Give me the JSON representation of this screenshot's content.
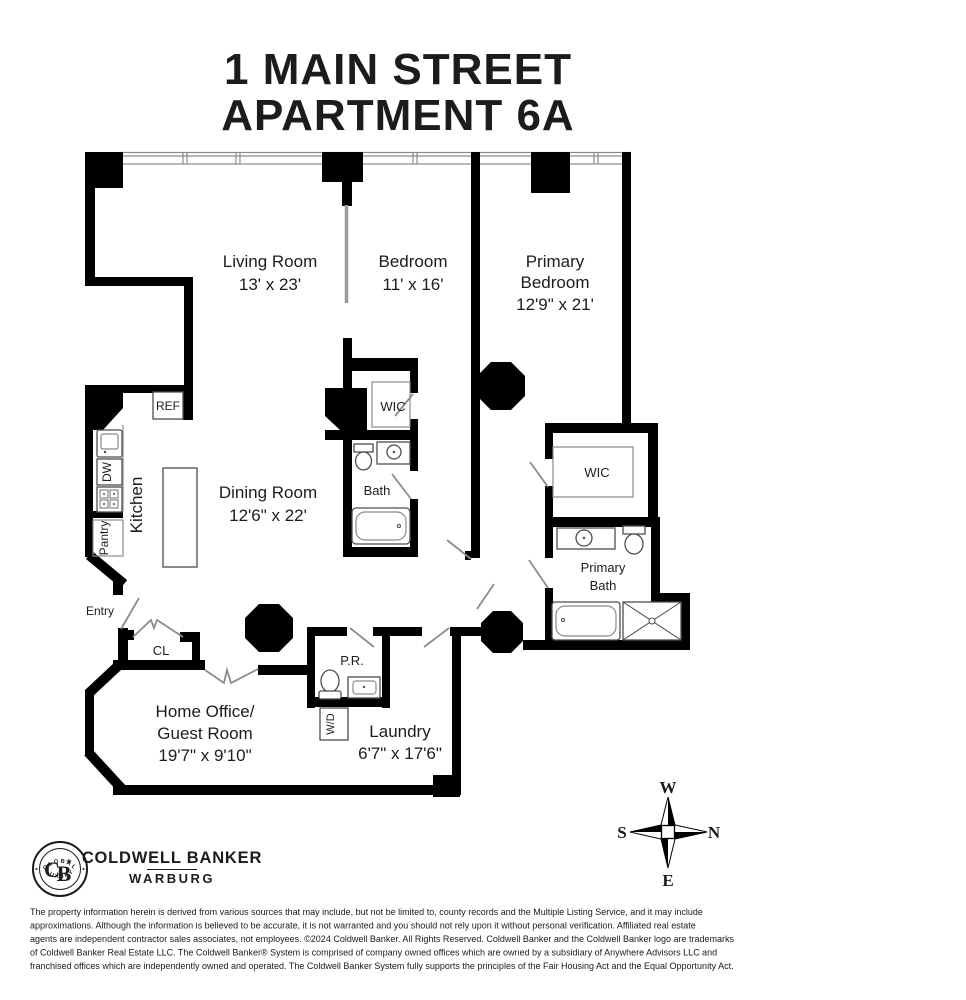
{
  "title": {
    "line1": "1 MAIN STREET",
    "line2": "APARTMENT 6A"
  },
  "rooms": {
    "living_room": {
      "name": "Living Room",
      "dims": "13' x 23'"
    },
    "bedroom": {
      "name": "Bedroom",
      "dims": "11' x 16'"
    },
    "primary_bedroom": {
      "name_line1": "Primary",
      "name_line2": "Bedroom",
      "dims": "12'9\" x 21'"
    },
    "dining_room": {
      "name": "Dining Room",
      "dims": "12'6\" x 22'"
    },
    "kitchen": {
      "name": "Kitchen"
    },
    "bath": {
      "name": "Bath"
    },
    "wic_bedroom": {
      "name": "WIC"
    },
    "wic_primary": {
      "name": "WIC"
    },
    "primary_bath": {
      "name_line1": "Primary",
      "name_line2": "Bath"
    },
    "home_office": {
      "name_line1": "Home Office/",
      "name_line2": "Guest Room",
      "dims": "19'7\" x 9'10\""
    },
    "laundry": {
      "name": "Laundry",
      "dims": "6'7\" x 17'6\""
    },
    "powder_room": {
      "name": "P.R."
    },
    "closet": {
      "name": "CL"
    },
    "entry": {
      "name": "Entry"
    }
  },
  "appliances": {
    "refrigerator": "REF",
    "dishwasher": "DW",
    "pantry": "Pantry",
    "washer_dryer": "W/D"
  },
  "compass": {
    "north": "N",
    "south": "S",
    "east": "E",
    "west": "W"
  },
  "logo": {
    "brand_line1": "COLDWELL BANKER",
    "brand_line2": "WARBURG",
    "badge_top": "GLOBAL",
    "badge_bottom": "LUXURY",
    "badge_monogram_c": "C",
    "badge_monogram_b": "B",
    "badge_star": "★"
  },
  "footer": {
    "lines": [
      "The property information herein is derived from various sources that may include, but not be limited to, county records and the Multiple Listing Service, and it may include",
      "approximations. Although the information is believed to be accurate, it is not warranted and you should not rely upon it without personal verification. Affiliated real estate",
      "agents are independent contractor sales associates, not employees. ©2024 Coldwell Banker. All Rights Reserved. Coldwell Banker and the Coldwell Banker logo are trademarks",
      "of Coldwell Banker Real Estate LLC. The Coldwell Banker® System is comprised of company owned offices which are owned by a subsidiary of Anywhere Advisors LLC and",
      "franchised offices which are independently owned and operated. The Coldwell Banker System fully supports the principles of the Fair Housing Act and the Equal Opportunity Act."
    ]
  },
  "colors": {
    "wall": "#000000",
    "door": "#8c8c8c",
    "fixture": "#4d4d4d",
    "text": "#1c1c1c"
  }
}
